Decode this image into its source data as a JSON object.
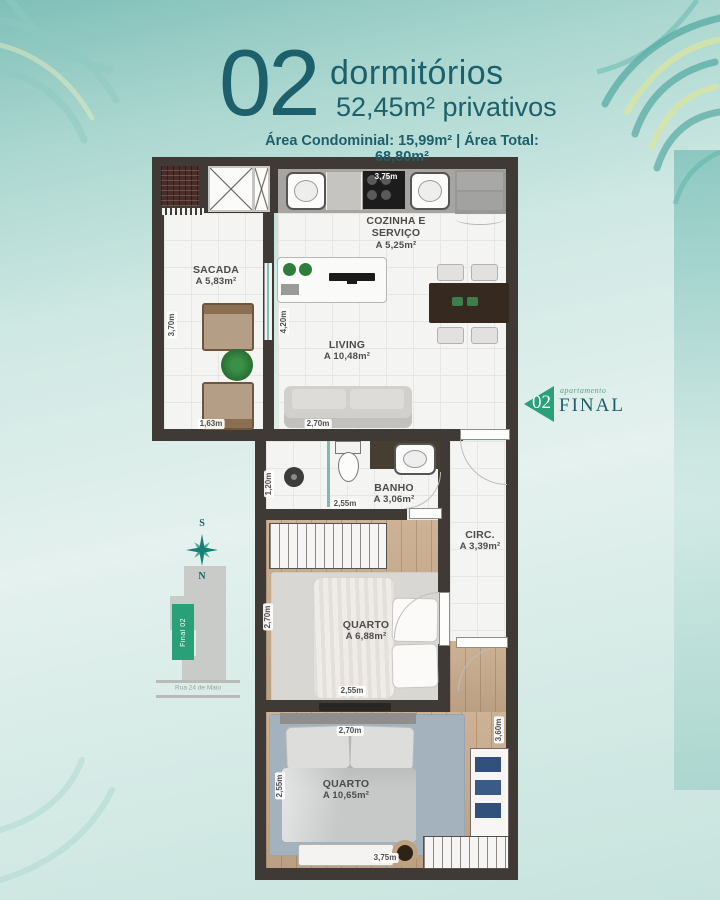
{
  "header": {
    "number": "02",
    "title": "dormitórios",
    "subtitle": "52,45m² privativos",
    "areas": "Área Condominial: 15,99m² | Área Total: 68,80m²"
  },
  "badge": {
    "number": "02",
    "small": "apartamento",
    "big": "FINAL"
  },
  "compass": {
    "south": "S",
    "north": "N"
  },
  "keyplan": {
    "unit": "Final 02",
    "street": "Rua 24 de Maio"
  },
  "rooms": [
    {
      "id": "sacada",
      "name": "SACADA",
      "area": "A 5,83m²"
    },
    {
      "id": "cozinha",
      "name": "COZINHA E SERVIÇO",
      "area": "A 5,25m²"
    },
    {
      "id": "living",
      "name": "LIVING",
      "area": "A 10,48m²"
    },
    {
      "id": "banho",
      "name": "BANHO",
      "area": "A 3,06m²"
    },
    {
      "id": "circ",
      "name": "CIRC.",
      "area": "A 3,39m²"
    },
    {
      "id": "quarto1",
      "name": "QUARTO",
      "area": "A 6,88m²"
    },
    {
      "id": "quarto2",
      "name": "QUARTO",
      "area": "A 10,65m²"
    }
  ],
  "dimensions": {
    "sacada_left": "3,70m",
    "sacada_bottom": "1,63m",
    "living_left": "4,20m",
    "sofa": "2,70m",
    "kitchen_top": "3,75m",
    "banho_left": "1,20m",
    "banho_bottom": "2,55m",
    "quarto1_left": "2,70m",
    "quarto1_bottom": "2,55m",
    "quarto2_top": "2,70m",
    "quarto2_left": "2,55m",
    "quarto2_right": "3,60m",
    "quarto2_bottom": "3,75m"
  },
  "colors": {
    "accent_green": "#2aa079",
    "teal_dark": "#1d606b",
    "wall": "#3f3a36"
  }
}
